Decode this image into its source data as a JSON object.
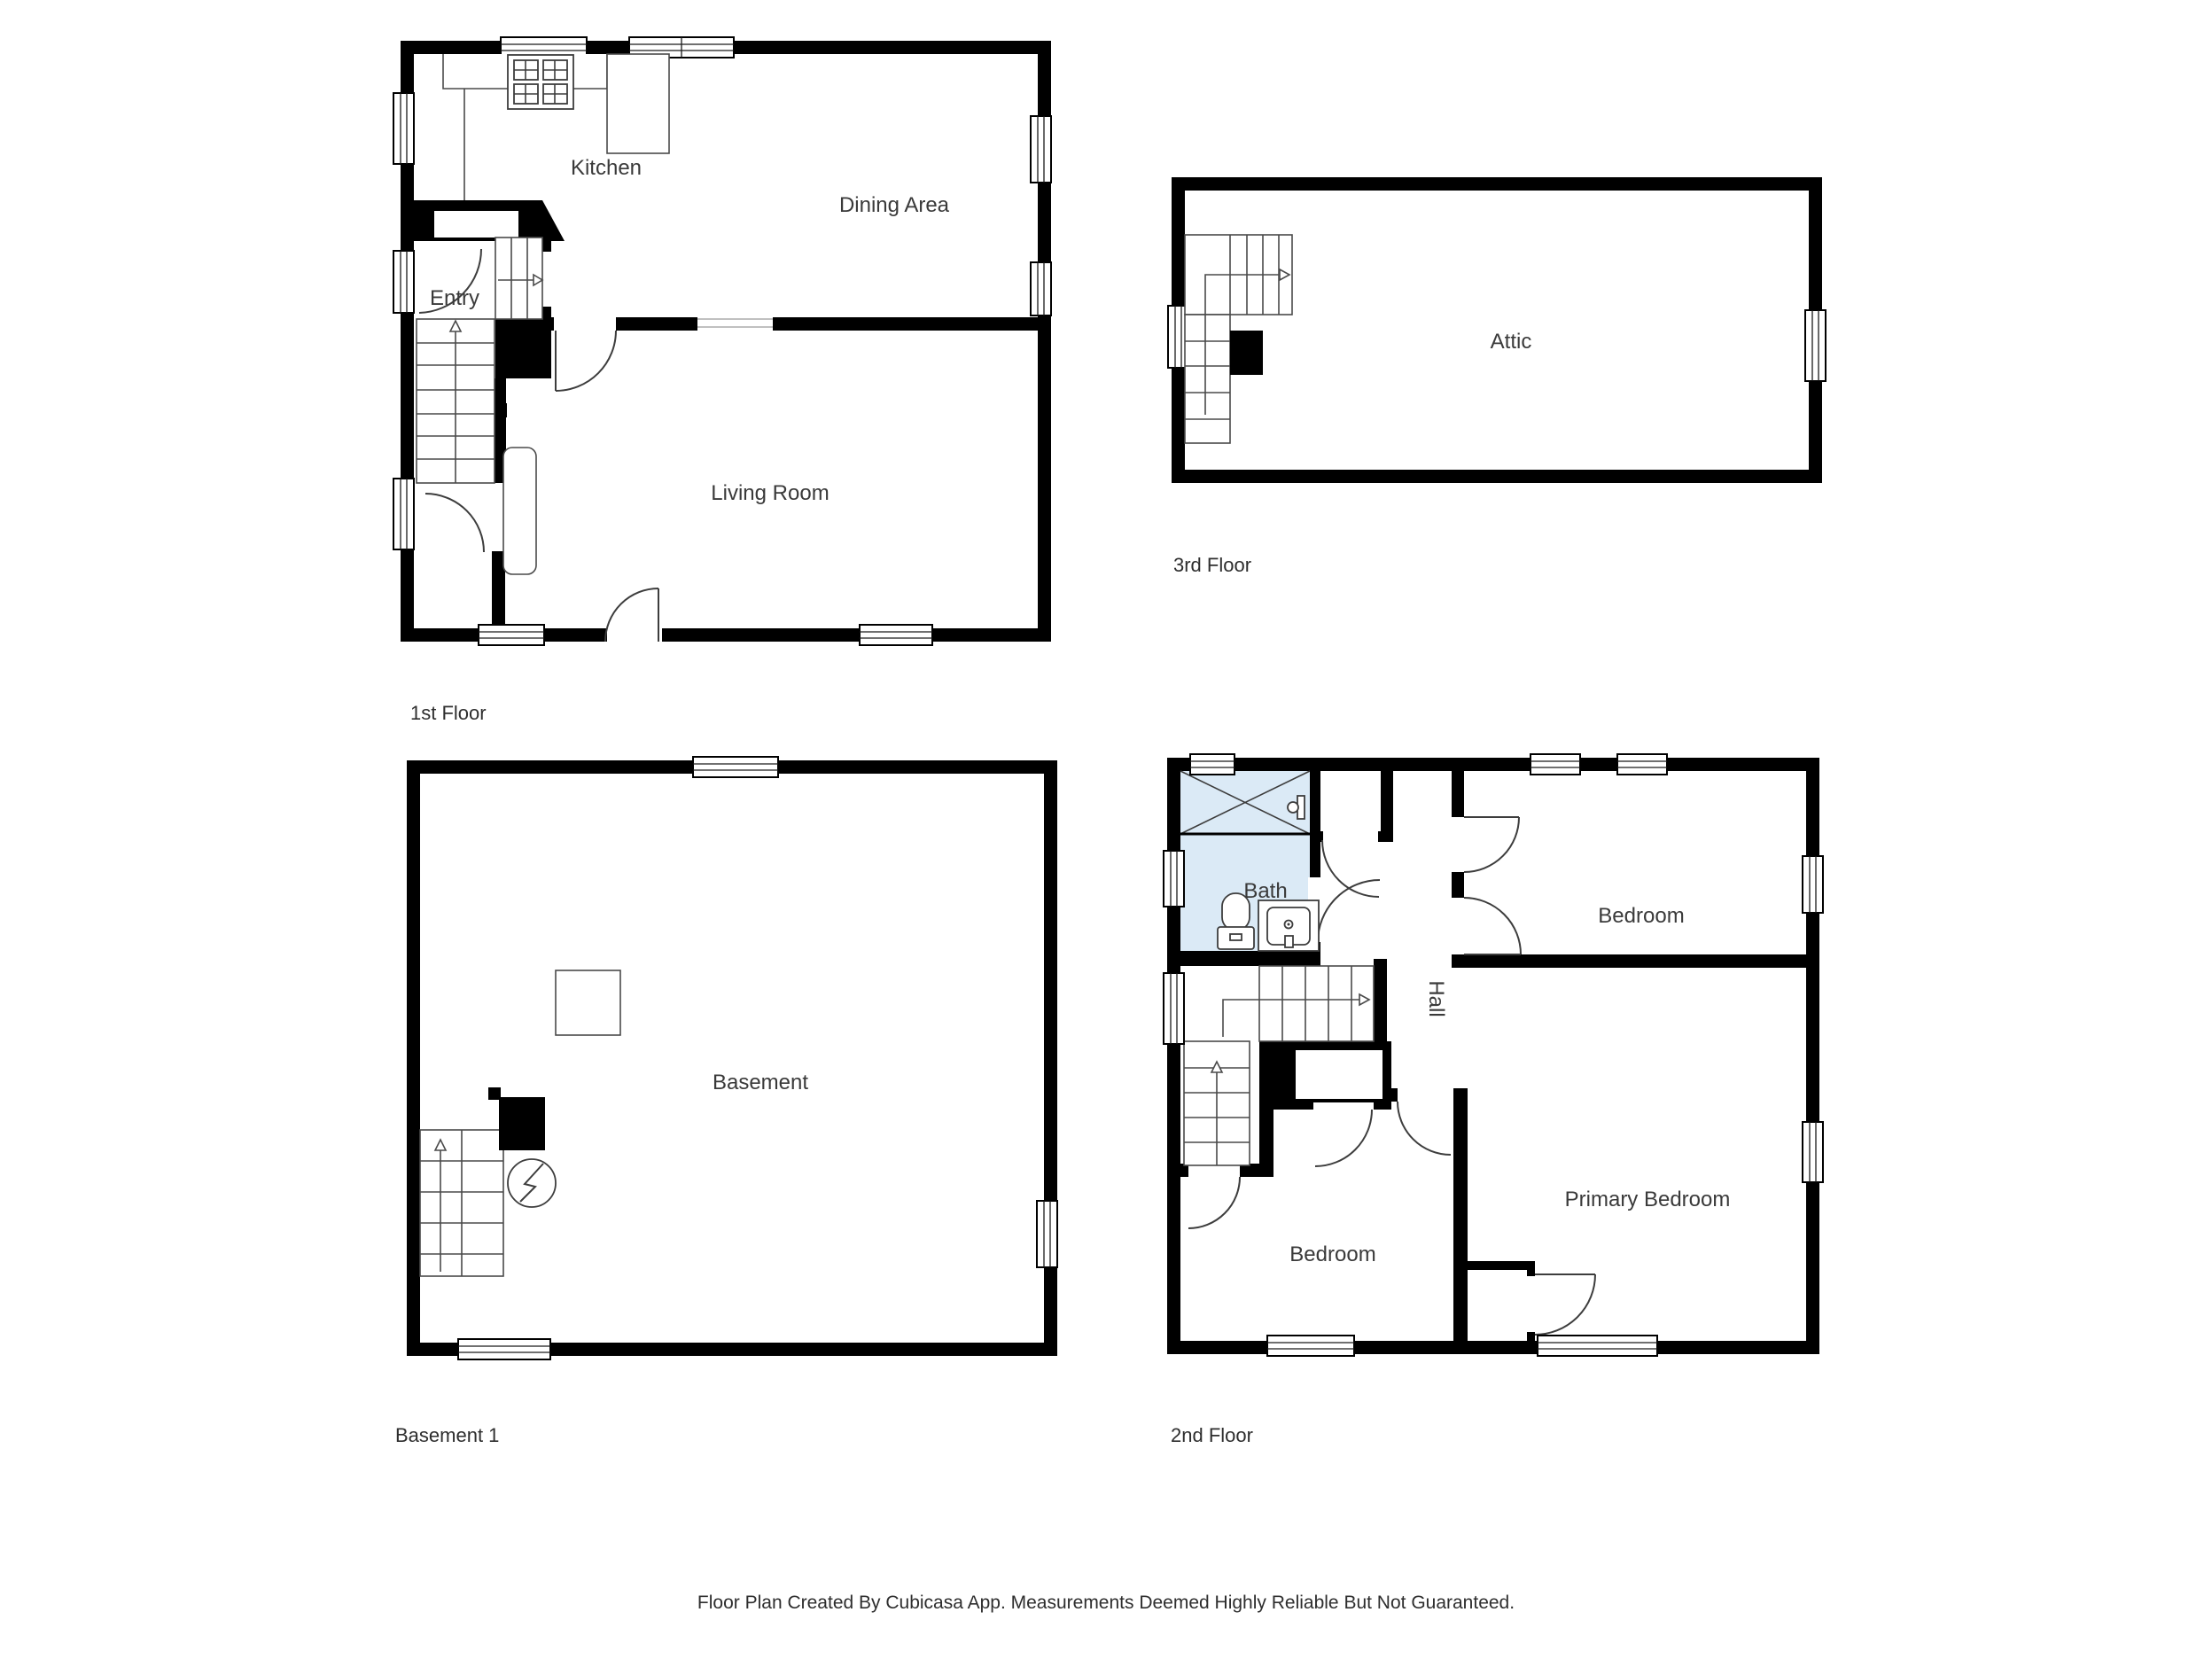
{
  "footer": {
    "text": "Floor Plan Created By Cubicasa App. Measurements Deemed Highly Reliable But Not Guaranteed."
  },
  "floors": [
    {
      "id": "first",
      "label": "1st Floor",
      "rooms": [
        "Kitchen",
        "Dining Area",
        "Entry",
        "Living Room"
      ]
    },
    {
      "id": "third",
      "label": "3rd Floor",
      "rooms": [
        "Attic"
      ]
    },
    {
      "id": "basement",
      "label": "Basement 1",
      "rooms": [
        "Basement"
      ]
    },
    {
      "id": "second",
      "label": "2nd Floor",
      "rooms": [
        "Bath",
        "Hall",
        "Bedroom",
        "Primary Bedroom",
        "Bedroom"
      ]
    }
  ],
  "icons": {
    "stove-icon": "4-burner gas range glyph",
    "toilet-icon": "toilet plan glyph",
    "sink-vanity-icon": "vanity with basin glyph",
    "bathtub-icon": "tub with X cross glyph",
    "shower-faucet-icon": "wall faucet glyph",
    "water-heater-icon": "circle with lightning glyph",
    "furnace-icon": "square outline glyph",
    "chimney-icon": "solid black block",
    "stairs-up-arrow-icon": "open triangle arrow",
    "window-icon": "double-line window glyph",
    "door-arc-icon": "quarter-circle door swing"
  },
  "colors": {
    "wall": "#000000",
    "bath_fill": "#dbeaf6",
    "line": "#3d3d3d",
    "text": "#3a3a3a",
    "background": "#ffffff"
  }
}
